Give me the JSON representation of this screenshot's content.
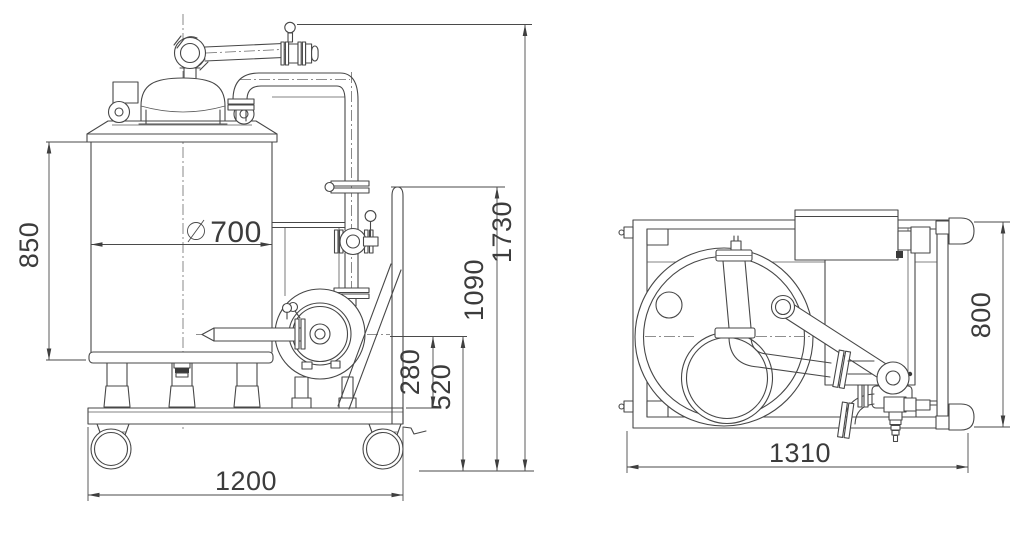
{
  "canvas": {
    "background": "#ffffff",
    "line_color": "#474747",
    "dimension_color": "#3c3c3c"
  },
  "views": {
    "side_view": {
      "name": "side-elevation",
      "parts": [
        "tank-vessel",
        "domed-lid",
        "lid-bracket",
        "lifting-lugs",
        "swing-arm-outlet-valve",
        "riser-pipe",
        "tri-clamp-fittings",
        "butterfly-valve",
        "pump",
        "suction-wand",
        "motor-bracket",
        "tank-legs",
        "drain-fitting",
        "trolley-base-plate",
        "swivel-casters",
        "brake-lever",
        "push-handle",
        "diagonal-brace"
      ],
      "dimensions": [
        {
          "id": "tank-body-height",
          "label": "850"
        },
        {
          "id": "tank-diameter",
          "symbol": "∅",
          "value": "700",
          "label": "∅700"
        },
        {
          "id": "pump-axis-above-base",
          "label": "280"
        },
        {
          "id": "pump-axis-height",
          "label": "520"
        },
        {
          "id": "handle-height",
          "label": "1090"
        },
        {
          "id": "overall-height",
          "label": "1730"
        },
        {
          "id": "base-length",
          "label": "1200"
        }
      ]
    },
    "top_view": {
      "name": "plan-view",
      "parts": [
        "tubular-frame",
        "corner-gussets",
        "tank-circle",
        "lid-circle",
        "port-circle",
        "swing-arm",
        "handle-tube",
        "handle-knob",
        "control-box",
        "motor-platform",
        "pump",
        "tri-clamp-fittings",
        "outlet-valve",
        "hose-barb",
        "casters"
      ],
      "dimensions": [
        {
          "id": "frame-width",
          "label": "800"
        },
        {
          "id": "overall-length",
          "label": "1310"
        }
      ]
    }
  }
}
